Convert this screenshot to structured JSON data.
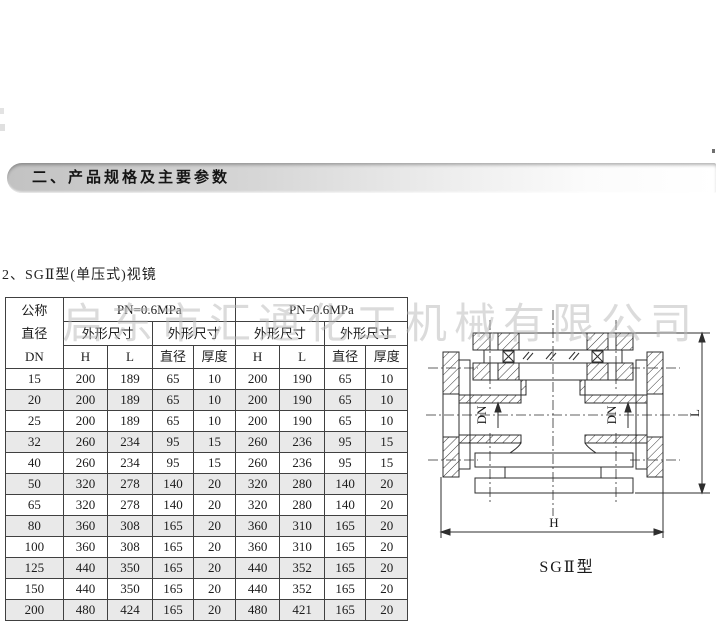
{
  "page": {
    "section_title": "二、产品规格及主要参数",
    "subtitle": "2、SGⅡ型(单压式)视镜",
    "watermark": "启东市汇通化工机械有限公司"
  },
  "table": {
    "dn_header": {
      "line1": "公称",
      "line2": "直径",
      "line3": "DN"
    },
    "groups": [
      {
        "title": "PN=0.6MPa",
        "subs": [
          "外形尺寸",
          "外形尺寸"
        ],
        "cols": [
          "H",
          "L",
          "直径",
          "厚度"
        ]
      },
      {
        "title": "PN=0.6MPa",
        "subs": [
          "外形尺寸",
          "外形尺寸"
        ],
        "cols": [
          "H",
          "L",
          "直径",
          "厚度"
        ]
      }
    ],
    "rows": [
      [
        "15",
        "200",
        "189",
        "65",
        "10",
        "200",
        "190",
        "65",
        "10"
      ],
      [
        "20",
        "200",
        "189",
        "65",
        "10",
        "200",
        "190",
        "65",
        "10"
      ],
      [
        "25",
        "200",
        "189",
        "65",
        "10",
        "200",
        "190",
        "65",
        "10"
      ],
      [
        "32",
        "260",
        "234",
        "95",
        "15",
        "260",
        "236",
        "95",
        "15"
      ],
      [
        "40",
        "260",
        "234",
        "95",
        "15",
        "260",
        "236",
        "95",
        "15"
      ],
      [
        "50",
        "320",
        "278",
        "140",
        "20",
        "320",
        "280",
        "140",
        "20"
      ],
      [
        "65",
        "320",
        "278",
        "140",
        "20",
        "320",
        "280",
        "140",
        "20"
      ],
      [
        "80",
        "360",
        "308",
        "165",
        "20",
        "360",
        "310",
        "165",
        "20"
      ],
      [
        "100",
        "360",
        "308",
        "165",
        "20",
        "360",
        "310",
        "165",
        "20"
      ],
      [
        "125",
        "440",
        "350",
        "165",
        "20",
        "440",
        "352",
        "165",
        "20"
      ],
      [
        "150",
        "440",
        "350",
        "165",
        "20",
        "440",
        "352",
        "165",
        "20"
      ],
      [
        "200",
        "480",
        "424",
        "165",
        "20",
        "480",
        "421",
        "165",
        "20"
      ]
    ]
  },
  "diagram": {
    "label": "SGⅡ型",
    "dim_dn": "DN",
    "dim_l": "L",
    "dim_h": "H"
  },
  "colors": {
    "zebra_row": "#e9e9e9",
    "table_border": "#404040",
    "bar_gray": "#c2c2c2"
  }
}
